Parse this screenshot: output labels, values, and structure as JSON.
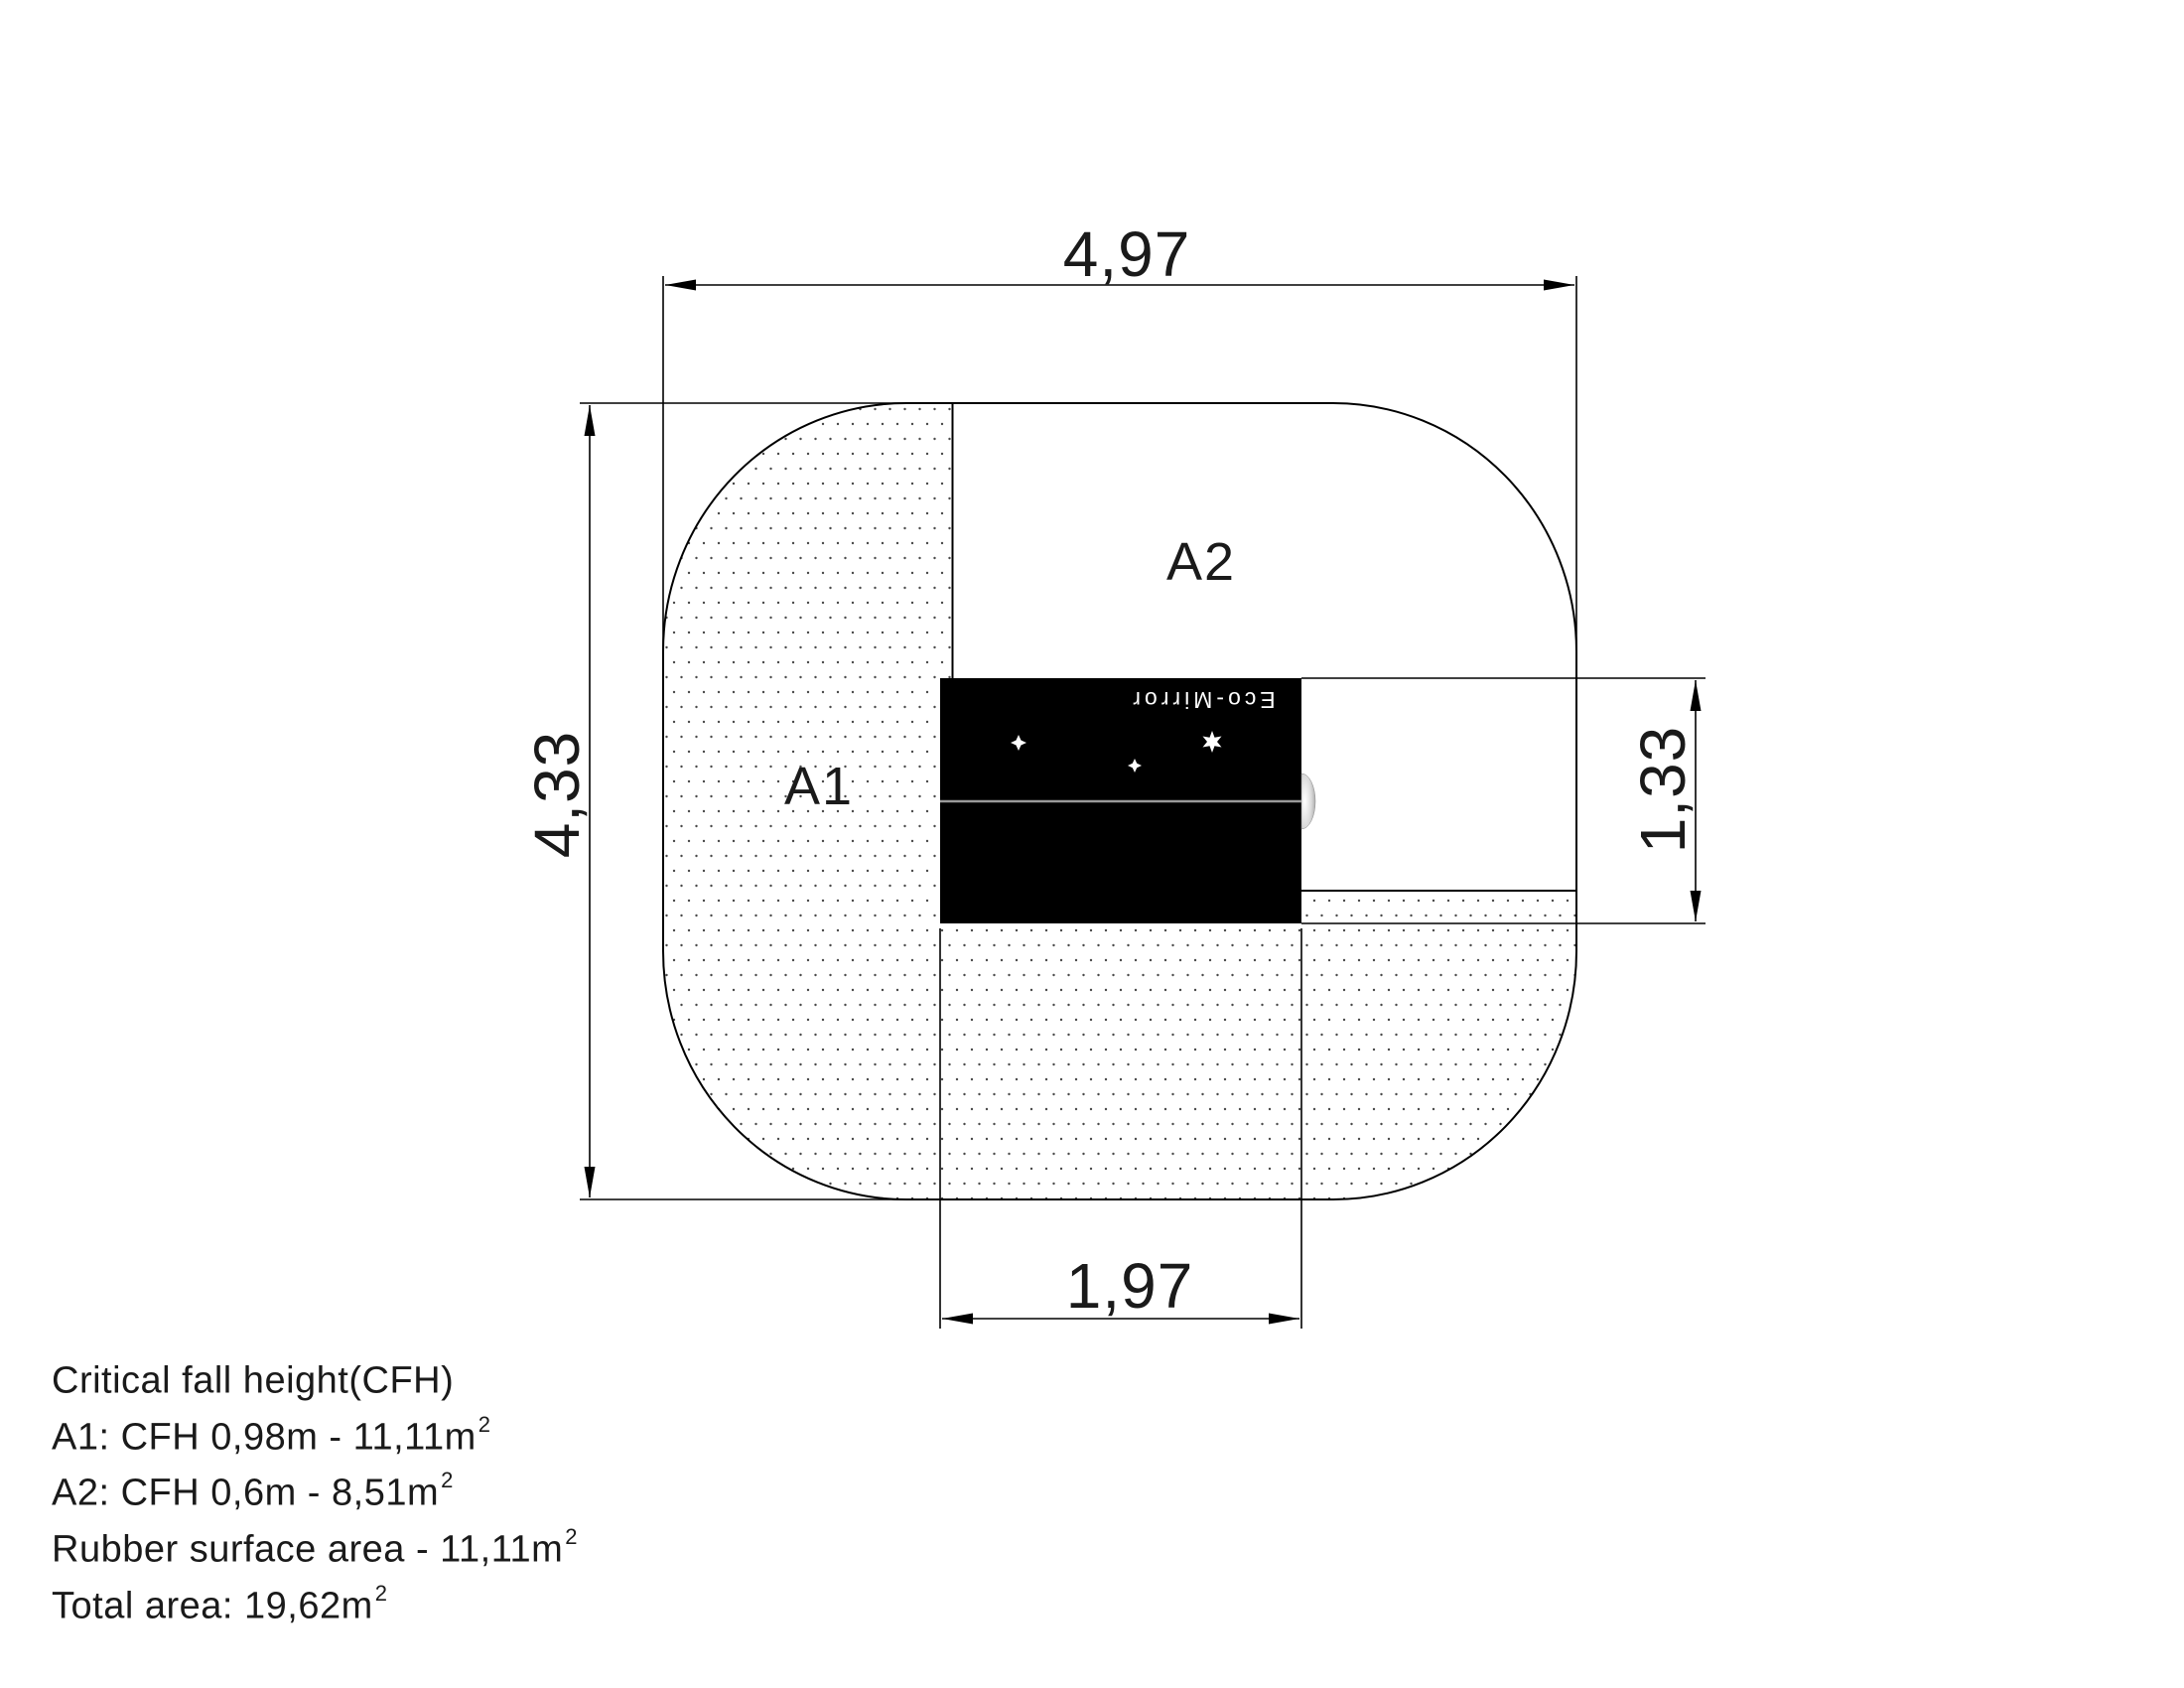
{
  "diagram": {
    "dimensions": {
      "top": "4,97",
      "left": "4,33",
      "right": "1,33",
      "bottom": "1,97"
    },
    "labels": {
      "a1": "A1",
      "a2": "A2"
    },
    "equipment_label": "Eco-Mirror",
    "icons": [
      "star-icon",
      "star-icon",
      "star-icon",
      "mirror-knob-icon"
    ],
    "colors": {
      "line": "#000000",
      "background": "#ffffff",
      "equipment_fill": "#000000",
      "panel_divider_gray": "#9a9a9a",
      "stipple_dot": "#4a4a4a"
    }
  },
  "footer": {
    "lines": [
      {
        "text": "Critical fall height(CFH)",
        "sup": ""
      },
      {
        "text": "A1: CFH 0,98m - 11,11m",
        "sup": "2"
      },
      {
        "text": "A2: CFH 0,6m - 8,51m",
        "sup": "2"
      },
      {
        "text": "Rubber surface area - 11,11m",
        "sup": "2"
      },
      {
        "text": "Total area: 19,62m",
        "sup": "2"
      }
    ]
  }
}
